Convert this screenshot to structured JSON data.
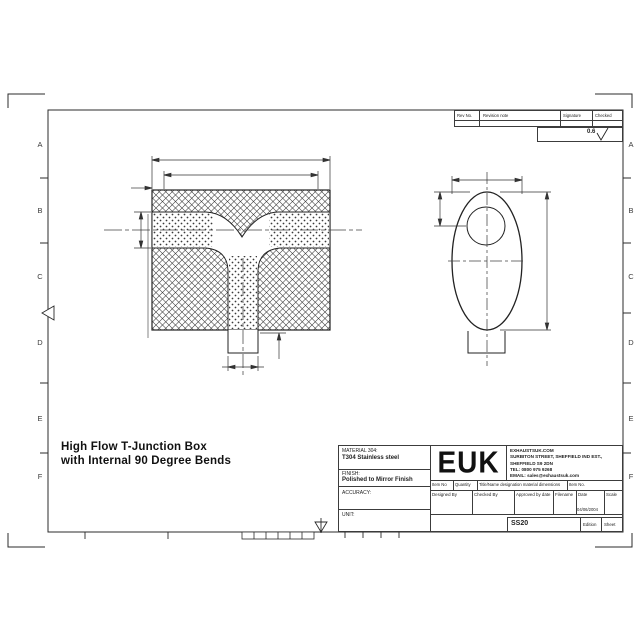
{
  "border": {
    "letters": [
      "A",
      "B",
      "C",
      "D",
      "E",
      "F"
    ]
  },
  "revision_table": {
    "rev_no": "Rev No.",
    "revision_note": "Revision note",
    "signature": "Signature",
    "checked": "Checked"
  },
  "surface_finish": {
    "value": "0.6"
  },
  "drawing_title": {
    "line1": "High Flow T-Junction Box",
    "line2": "with Internal 90 Degree Bends"
  },
  "title_block": {
    "material_label": "MATERIAL 304:",
    "material_value": "T304 Stainless steel",
    "finish_label": "FINISH:",
    "finish_value": "Polished to Mirror Finish",
    "accuracy_label": "ACCURACY:",
    "unit_label": "UNIT:",
    "logo_text": "EUK",
    "company_line1": "EXHAUSTSUK.COM",
    "company_line2": "SURBITON STREET, SHEFFIELD IND EST.,",
    "company_line3": "SHEFFIELD S9 2DN",
    "company_line4": "TEL: 0800 975 9268",
    "company_line5": "EMAIL: sales@exhaustsuk.com",
    "item_no_label": "Item No",
    "quantity_label": "Quantity",
    "designation_label": "Title/Name designation material dimensions",
    "item_no2_label": "Item No.",
    "designed_by_label": "Designed By",
    "checked_by_label": "Checked By",
    "approved_label": "Approved by date",
    "filename_label": "Filename",
    "date_label": "Date",
    "date_value": "04/06/2004",
    "scale_label": "Scale",
    "drawing_number": "SS20",
    "edition_label": "Edition",
    "sheet_label": "Sheet"
  }
}
